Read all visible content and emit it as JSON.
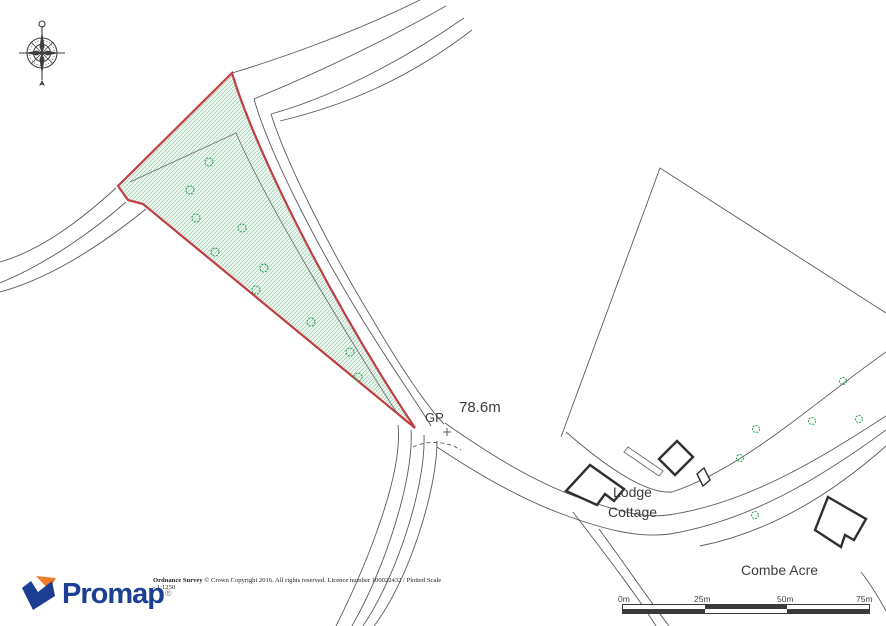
{
  "map": {
    "gp_label": "GP",
    "spot_height": "78.6m",
    "lodge_line1": "Lodge",
    "lodge_line2": "Cottage",
    "combe_acre": "Combe Acre",
    "colors": {
      "plot_boundary": "#bf4044",
      "plot_fill": "#edf6f0",
      "hatch": "#9ccbad",
      "tree": "#2fa35f",
      "line": "#5a5a5a",
      "building": "#2f2f2f"
    }
  },
  "footer": {
    "brand": "Promap",
    "registered": "®",
    "copyright_bold": "Ordnance Survey",
    "copyright_text": " © Crown Copyright 2016. All rights reserved. Licence number 100022432 / Plotted Scale -  1:1250",
    "brand_blue": "#1c3f94",
    "brand_orange": "#f07d28"
  },
  "scalebar": {
    "labels": [
      "0m",
      "25m",
      "50m",
      "75m"
    ]
  }
}
